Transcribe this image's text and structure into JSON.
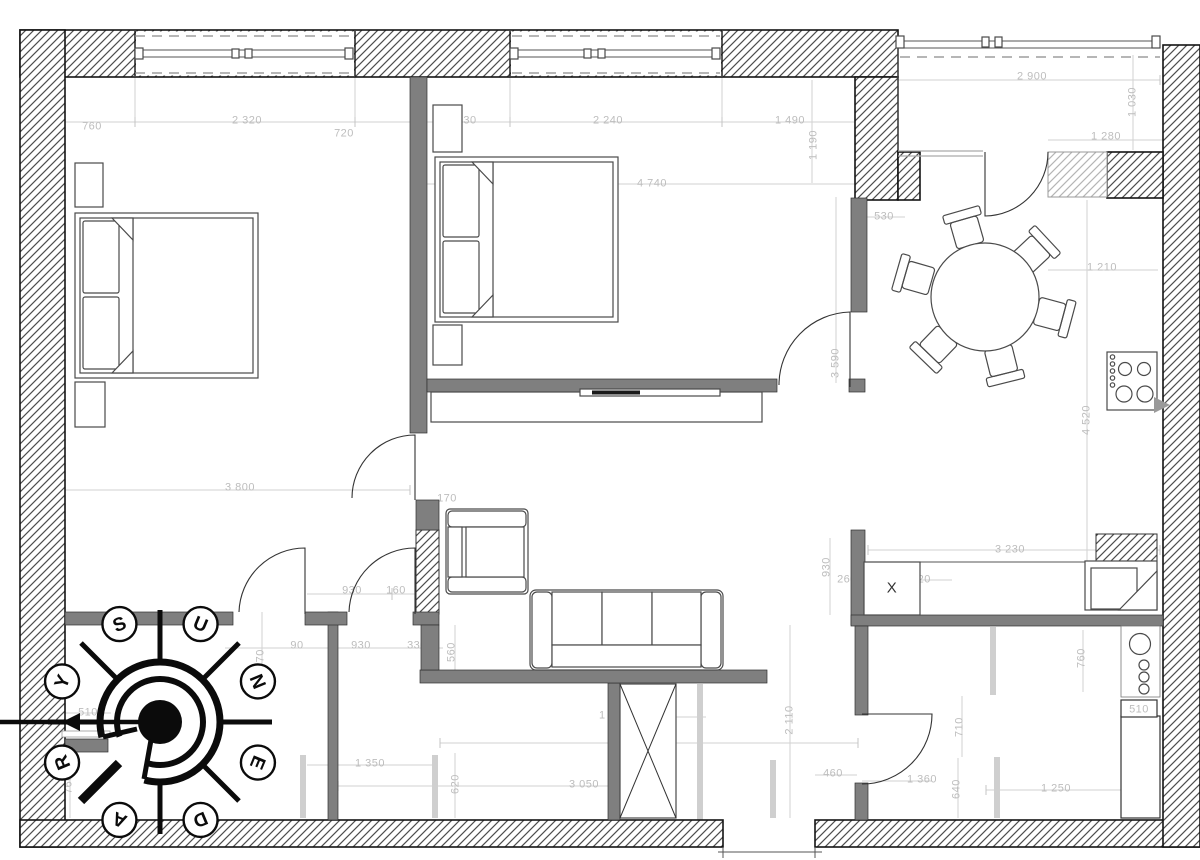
{
  "drawing": {
    "kind": "apartment floor plan",
    "units": "mm"
  },
  "dims": [
    {
      "t": "760",
      "x": 92,
      "y": 126
    },
    {
      "t": "2 320",
      "x": 247,
      "y": 120
    },
    {
      "t": "720",
      "x": 344,
      "y": 133
    },
    {
      "t": "30",
      "x": 470,
      "y": 120
    },
    {
      "t": "2 240",
      "x": 608,
      "y": 120
    },
    {
      "t": "1 490",
      "x": 790,
      "y": 120
    },
    {
      "t": "1 190",
      "x": 813,
      "y": 145,
      "rot": -90
    },
    {
      "t": "4 740",
      "x": 652,
      "y": 183
    },
    {
      "t": "530",
      "x": 884,
      "y": 216
    },
    {
      "t": "2 900",
      "x": 1032,
      "y": 76
    },
    {
      "t": "1 030",
      "x": 1132,
      "y": 102,
      "rot": -90
    },
    {
      "t": "1 280",
      "x": 1106,
      "y": 136
    },
    {
      "t": "1 210",
      "x": 1102,
      "y": 267
    },
    {
      "t": "4 520",
      "x": 1086,
      "y": 420,
      "rot": -90
    },
    {
      "t": "3 590",
      "x": 835,
      "y": 363,
      "rot": -90
    },
    {
      "t": "3 800",
      "x": 240,
      "y": 487
    },
    {
      "t": "170",
      "x": 447,
      "y": 498
    },
    {
      "t": "930",
      "x": 352,
      "y": 590
    },
    {
      "t": "160",
      "x": 396,
      "y": 590
    },
    {
      "t": "90",
      "x": 297,
      "y": 645
    },
    {
      "t": "930",
      "x": 361,
      "y": 645
    },
    {
      "t": "330",
      "x": 417,
      "y": 645
    },
    {
      "t": "560",
      "x": 451,
      "y": 652,
      "rot": -90
    },
    {
      "t": "770",
      "x": 260,
      "y": 659,
      "rot": -90
    },
    {
      "t": "510",
      "x": 88,
      "y": 712
    },
    {
      "t": "1 030",
      "x": 44,
      "y": 736
    },
    {
      "t": "760",
      "x": 68,
      "y": 784,
      "rot": -90
    },
    {
      "t": "1 350",
      "x": 370,
      "y": 763
    },
    {
      "t": "620",
      "x": 455,
      "y": 784,
      "rot": -90
    },
    {
      "t": "3 050",
      "x": 584,
      "y": 784
    },
    {
      "t": "1 080",
      "x": 614,
      "y": 715
    },
    {
      "t": "4 620",
      "x": 649,
      "y": 742
    },
    {
      "t": "2 110",
      "x": 789,
      "y": 720,
      "rot": -90
    },
    {
      "t": "460",
      "x": 833,
      "y": 773
    },
    {
      "t": "1 360",
      "x": 922,
      "y": 779
    },
    {
      "t": "710",
      "x": 959,
      "y": 727,
      "rot": -90
    },
    {
      "t": "640",
      "x": 956,
      "y": 789,
      "rot": -90
    },
    {
      "t": "1 250",
      "x": 1056,
      "y": 788
    },
    {
      "t": "760",
      "x": 1081,
      "y": 658,
      "rot": -90
    },
    {
      "t": "930",
      "x": 826,
      "y": 567,
      "rot": -90
    },
    {
      "t": "260",
      "x": 847,
      "y": 579
    },
    {
      "t": "920",
      "x": 921,
      "y": 579
    },
    {
      "t": "3 230",
      "x": 1010,
      "y": 549
    },
    {
      "t": "510",
      "x": 1139,
      "y": 709,
      "boxed": true,
      "top": true
    },
    {
      "t": "X",
      "x": 892,
      "y": 589,
      "dark": true,
      "top": true
    }
  ],
  "compass": {
    "letters": [
      "Y",
      "S",
      "U",
      "N",
      "E",
      "D",
      "A",
      "R"
    ],
    "angles": [
      157.5,
      112.5,
      67.5,
      22.5,
      -22.5,
      -67.5,
      -112.5,
      -157.5
    ],
    "cx": 160,
    "cy": 722,
    "radius": 106
  },
  "colors": {
    "interior_wall": "#7f7f7f",
    "hatch_line": "#4d4d4d",
    "dimension_text": "#bdbdbd",
    "line": "#4a4a4a"
  }
}
